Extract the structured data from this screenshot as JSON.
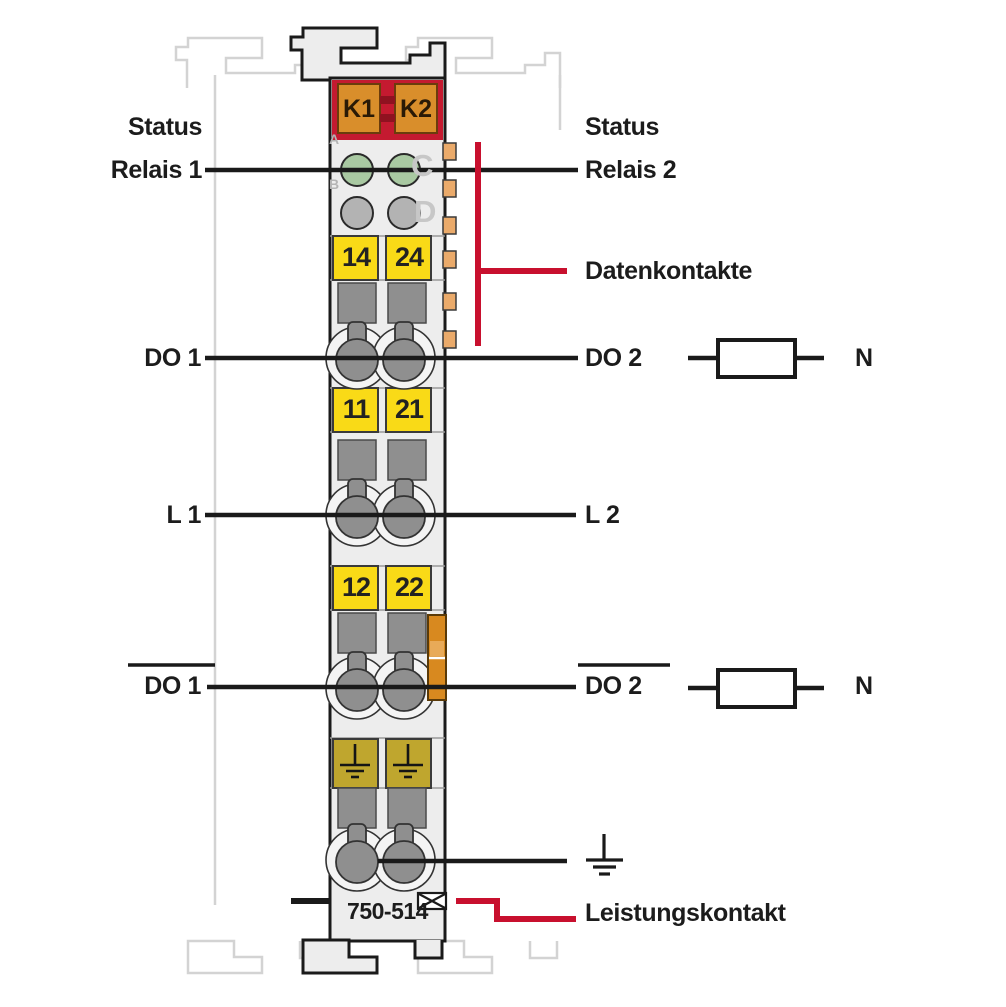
{
  "diagram": {
    "model_number": "750-514",
    "left_labels": {
      "status_line1": "Status",
      "status_line2": "Relais 1",
      "do1": "DO 1",
      "l1": "L 1",
      "do1_inverted": "DO 1"
    },
    "right_labels": {
      "status_line1": "Status",
      "status_line2": "Relais 2",
      "datenkontakte": "Datenkontakte",
      "do2": "DO 2",
      "n_upper": "N",
      "l2": "L 2",
      "do2_inverted": "DO 2",
      "n_lower": "N",
      "leistungskontakt": "Leistungskontakt"
    },
    "relay_plates": {
      "k1": "K1",
      "k2": "K2"
    },
    "led_labels": {
      "a": "A",
      "b": "B",
      "c": "C",
      "d": "D"
    },
    "terminal_numbers": {
      "row1": [
        "14",
        "24"
      ],
      "row2": [
        "11",
        "21"
      ],
      "row3": [
        "12",
        "22"
      ]
    },
    "colors": {
      "annotation_red": "#c8102e",
      "relay_block_red": "#c41a30",
      "relay_plate_orange": "#d98e2b",
      "terminal_yellow": "#f9da17",
      "ground_khaki": "#bfa62e",
      "led_green": "#a9c9a2",
      "led_gray": "#b3b3b3",
      "module_body_gray": "#ededed",
      "data_contact_tan": "#eaaa6a",
      "power_contact_orange": "#d8891f"
    }
  }
}
